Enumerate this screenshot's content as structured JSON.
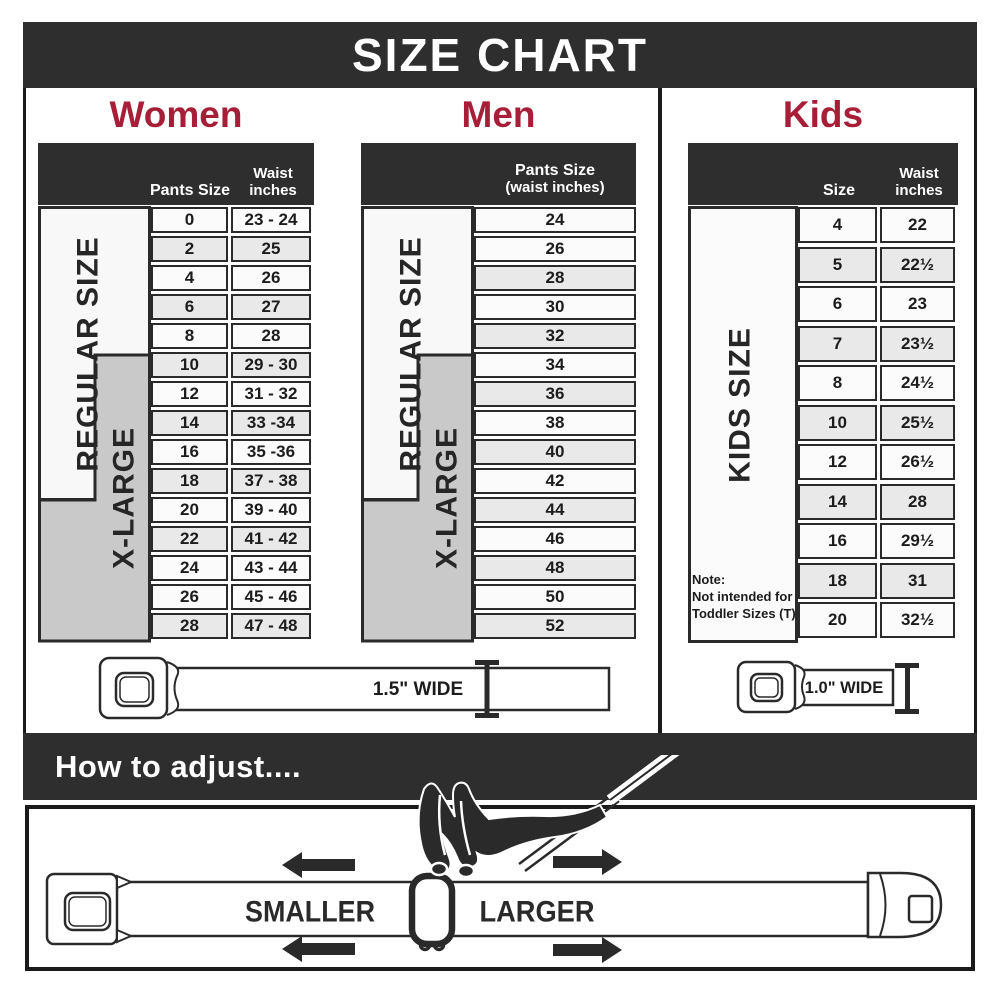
{
  "title": "SIZE CHART",
  "sections": {
    "women": {
      "label": "Women",
      "col1": "Pants Size",
      "col2_line1": "Waist",
      "col2_line2": "inches",
      "regular_label": "REGULAR SIZE",
      "xlarge_label": "X-LARGE",
      "rows": [
        {
          "size": "0",
          "waist": "23 - 24",
          "shaded": false
        },
        {
          "size": "2",
          "waist": "25",
          "shaded": true
        },
        {
          "size": "4",
          "waist": "26",
          "shaded": false
        },
        {
          "size": "6",
          "waist": "27",
          "shaded": true
        },
        {
          "size": "8",
          "waist": "28",
          "shaded": false
        },
        {
          "size": "10",
          "waist": "29 - 30",
          "shaded": true
        },
        {
          "size": "12",
          "waist": "31 - 32",
          "shaded": false
        },
        {
          "size": "14",
          "waist": "33 -34",
          "shaded": true
        },
        {
          "size": "16",
          "waist": "35 -36",
          "shaded": false
        },
        {
          "size": "18",
          "waist": "37 - 38",
          "shaded": true
        },
        {
          "size": "20",
          "waist": "39 - 40",
          "shaded": false
        },
        {
          "size": "22",
          "waist": "41 - 42",
          "shaded": true
        },
        {
          "size": "24",
          "waist": "43 - 44",
          "shaded": false
        },
        {
          "size": "26",
          "waist": "45 - 46",
          "shaded": false
        },
        {
          "size": "28",
          "waist": "47 - 48",
          "shaded": true
        }
      ]
    },
    "men": {
      "label": "Men",
      "header_line1": "Pants Size",
      "header_line2": "(waist inches)",
      "regular_label": "REGULAR SIZE",
      "xlarge_label": "X-LARGE",
      "rows": [
        {
          "size": "24",
          "shaded": false
        },
        {
          "size": "26",
          "shaded": false
        },
        {
          "size": "28",
          "shaded": true
        },
        {
          "size": "30",
          "shaded": false
        },
        {
          "size": "32",
          "shaded": true
        },
        {
          "size": "34",
          "shaded": false
        },
        {
          "size": "36",
          "shaded": true
        },
        {
          "size": "38",
          "shaded": false
        },
        {
          "size": "40",
          "shaded": true
        },
        {
          "size": "42",
          "shaded": false
        },
        {
          "size": "44",
          "shaded": true
        },
        {
          "size": "46",
          "shaded": false
        },
        {
          "size": "48",
          "shaded": true
        },
        {
          "size": "50",
          "shaded": false
        },
        {
          "size": "52",
          "shaded": true
        }
      ]
    },
    "kids": {
      "label": "Kids",
      "col1": "Size",
      "col2_line1": "Waist",
      "col2_line2": "inches",
      "side_label": "KIDS SIZE",
      "note_line1": "Note:",
      "note_line2": "Not intended for",
      "note_line3": "Toddler Sizes (T)",
      "rows": [
        {
          "size": "4",
          "waist": "22",
          "shaded": false
        },
        {
          "size": "5",
          "waist": "22½",
          "shaded": true
        },
        {
          "size": "6",
          "waist": "23",
          "shaded": false
        },
        {
          "size": "7",
          "waist": "23½",
          "shaded": true
        },
        {
          "size": "8",
          "waist": "24½",
          "shaded": false
        },
        {
          "size": "10",
          "waist": "25½",
          "shaded": true
        },
        {
          "size": "12",
          "waist": "26½",
          "shaded": false
        },
        {
          "size": "14",
          "waist": "28",
          "shaded": true
        },
        {
          "size": "16",
          "waist": "29½",
          "shaded": false
        },
        {
          "size": "18",
          "waist": "31",
          "shaded": true
        },
        {
          "size": "20",
          "waist": "32½",
          "shaded": false
        }
      ]
    }
  },
  "belts": {
    "adult_width_label": "1.5\" WIDE",
    "kids_width_label": "1.0\" WIDE"
  },
  "adjust": {
    "heading": "How to adjust....",
    "smaller_label": "SMALLER",
    "larger_label": "LARGER"
  },
  "colors": {
    "bar_dark": "#2e2e2e",
    "accent_red": "#a81e38",
    "row_shaded": "#e9e9e9",
    "row_plain": "#fbfbfb",
    "xlarge_gray": "#c9c9c9",
    "ink": "#2a2a2a"
  },
  "chart_data": [
    {
      "type": "table",
      "title": "Women",
      "columns": [
        "Pants Size",
        "Waist inches"
      ],
      "rows": [
        [
          "0",
          "23 - 24"
        ],
        [
          "2",
          "25"
        ],
        [
          "4",
          "26"
        ],
        [
          "6",
          "27"
        ],
        [
          "8",
          "28"
        ],
        [
          "10",
          "29 - 30"
        ],
        [
          "12",
          "31 - 32"
        ],
        [
          "14",
          "33 -34"
        ],
        [
          "16",
          "35 -36"
        ],
        [
          "18",
          "37 - 38"
        ],
        [
          "20",
          "39 - 40"
        ],
        [
          "22",
          "41 - 42"
        ],
        [
          "24",
          "43 - 44"
        ],
        [
          "26",
          "45 - 46"
        ],
        [
          "28",
          "47 - 48"
        ]
      ],
      "annotations": {
        "regular_size_rows": "0-18",
        "x_large_rows": "10-28"
      }
    },
    {
      "type": "table",
      "title": "Men",
      "columns": [
        "Pants Size (waist inches)"
      ],
      "rows": [
        [
          "24"
        ],
        [
          "26"
        ],
        [
          "28"
        ],
        [
          "30"
        ],
        [
          "32"
        ],
        [
          "34"
        ],
        [
          "36"
        ],
        [
          "38"
        ],
        [
          "40"
        ],
        [
          "42"
        ],
        [
          "44"
        ],
        [
          "46"
        ],
        [
          "48"
        ],
        [
          "50"
        ],
        [
          "52"
        ]
      ],
      "annotations": {
        "regular_size_rows": "24-32",
        "x_large_rows": "34-52"
      }
    },
    {
      "type": "table",
      "title": "Kids",
      "columns": [
        "Size",
        "Waist inches"
      ],
      "rows": [
        [
          "4",
          "22"
        ],
        [
          "5",
          "22½"
        ],
        [
          "6",
          "23"
        ],
        [
          "7",
          "23½"
        ],
        [
          "8",
          "24½"
        ],
        [
          "10",
          "25½"
        ],
        [
          "12",
          "26½"
        ],
        [
          "14",
          "28"
        ],
        [
          "16",
          "29½"
        ],
        [
          "18",
          "31"
        ],
        [
          "20",
          "32½"
        ]
      ],
      "annotations": {
        "note": "Not intended for Toddler Sizes (T)"
      }
    }
  ]
}
